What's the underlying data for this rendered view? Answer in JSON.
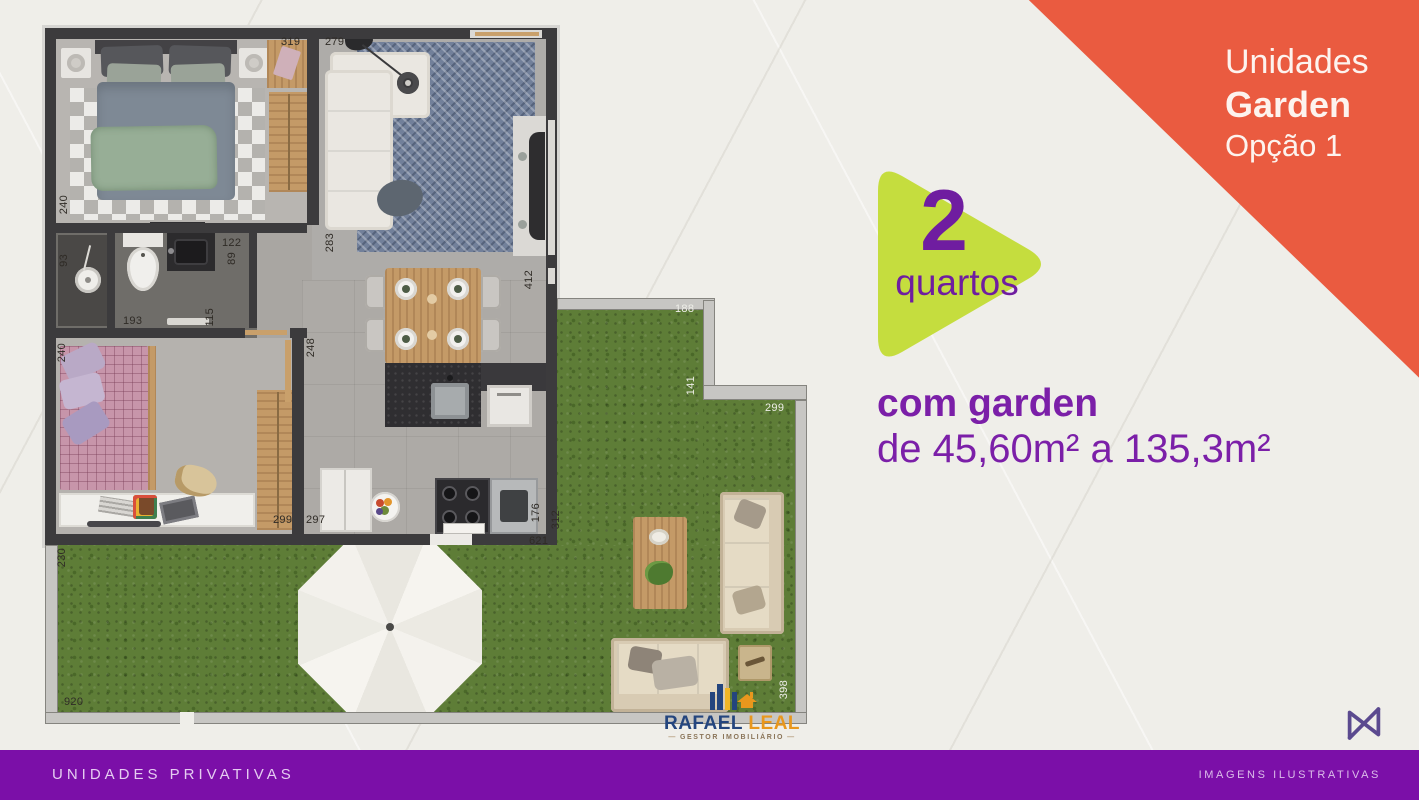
{
  "badge": {
    "line1": "Unidades",
    "line2": "Garden",
    "line3": "Opção 1"
  },
  "highlight": {
    "number": "2",
    "label": "quartos"
  },
  "description": {
    "line1": "com garden",
    "line2": "de 45,60m² a 135,3m²"
  },
  "footer": {
    "left": "UNIDADES PRIVATIVAS",
    "right": "IMAGENS ILUSTRATIVAS"
  },
  "brand": {
    "name1": "RAFAEL",
    "name2": "LEAL",
    "subtitle": "GESTOR IMOBILIÁRIO"
  },
  "colors": {
    "banner_orange": "#ea5b40",
    "shape_green": "#c5dd3e",
    "text_purple": "#7b1fa8",
    "footer_purple": "#7b0fa8",
    "grass_green": "#5e7d37"
  },
  "floorplan": {
    "dims": [
      {
        "t": "319"
      },
      {
        "t": "279"
      },
      {
        "t": "240"
      },
      {
        "t": "122"
      },
      {
        "t": "89"
      },
      {
        "t": "283"
      },
      {
        "t": "412"
      },
      {
        "t": "93"
      },
      {
        "t": "193"
      },
      {
        "t": "115"
      },
      {
        "t": "248"
      },
      {
        "t": "240"
      },
      {
        "t": "299"
      },
      {
        "t": "297"
      },
      {
        "t": "176"
      },
      {
        "t": "312"
      },
      {
        "t": "621"
      },
      {
        "t": "188"
      },
      {
        "t": "141"
      },
      {
        "t": "299"
      },
      {
        "t": "230"
      },
      {
        "t": "920"
      },
      {
        "t": "398"
      }
    ]
  }
}
